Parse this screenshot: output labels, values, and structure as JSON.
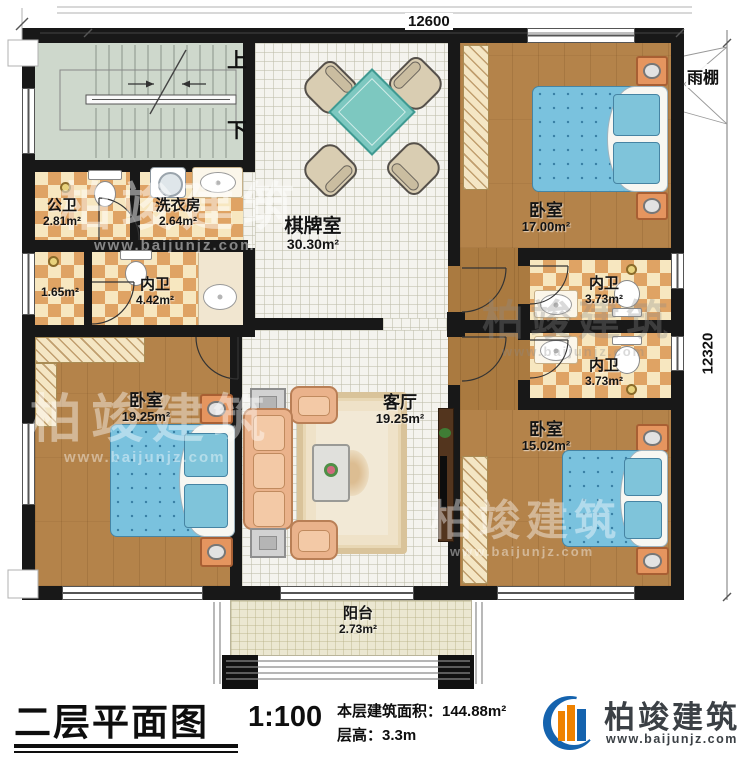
{
  "plan": {
    "dimensions": {
      "top": "12600",
      "right": "12320"
    },
    "stairs": {
      "up": "上",
      "down": "下"
    },
    "canopy_label": "雨棚",
    "rooms": [
      {
        "name": "公卫",
        "area": "2.81m²"
      },
      {
        "name": "洗衣房",
        "area": "2.64m²"
      },
      {
        "name": "棋牌室",
        "area": "30.30m²"
      },
      {
        "name": "卧室",
        "area": "17.00m²"
      },
      {
        "name": "",
        "area": "1.65m²"
      },
      {
        "name": "内卫",
        "area": "4.42m²"
      },
      {
        "name": "内卫",
        "area": "3.73m²"
      },
      {
        "name": "内卫",
        "area": "3.73m²"
      },
      {
        "name": "卧室",
        "area": "19.25m²"
      },
      {
        "name": "客厅",
        "area": "19.25m²"
      },
      {
        "name": "卧室",
        "area": "15.02m²"
      },
      {
        "name": "阳台",
        "area": "2.73m²"
      }
    ]
  },
  "title_block": {
    "drawing_title": "二层平面图",
    "scale": "1:100",
    "floor_area": "本层建筑面积：144.88m²",
    "floor_height": "层高：3.3m",
    "company": "柏竣建筑",
    "website": "www.baijunjz.com"
  },
  "watermark": {
    "text": "柏竣建筑",
    "url": "www.baijunjz.com"
  }
}
